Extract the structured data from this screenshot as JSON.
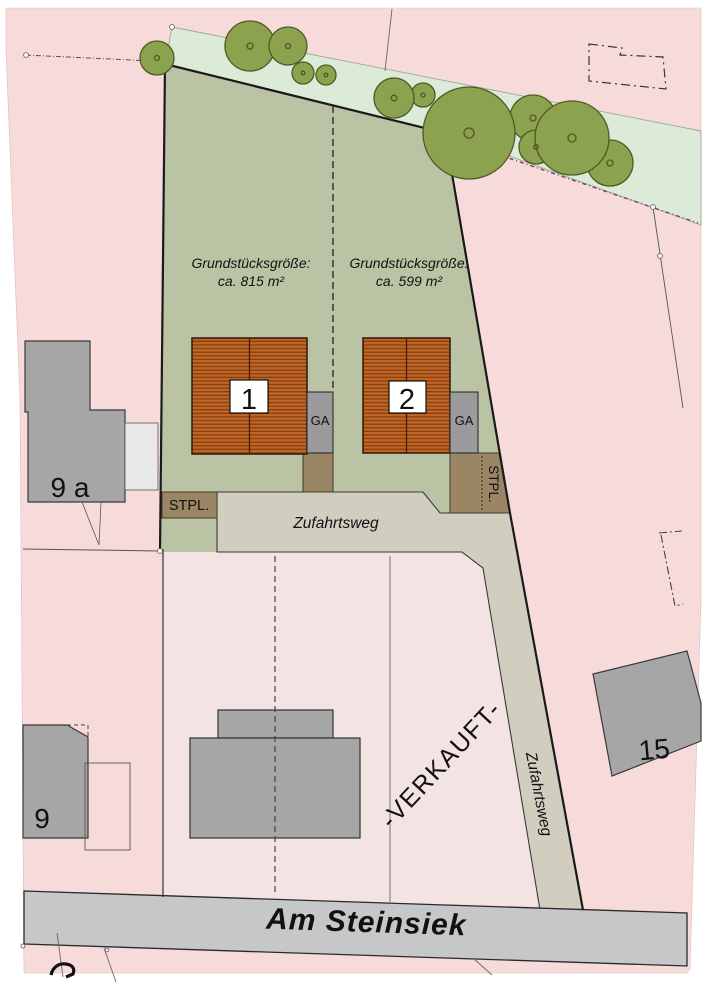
{
  "canvas": {
    "width": 707,
    "height": 1000
  },
  "plots": [
    {
      "size_label": "Grundstücksgröße:",
      "size_value": "ca. 815 m²",
      "house_number": "1",
      "garage_label": "GA"
    },
    {
      "size_label": "Grundstücksgröße:",
      "size_value": "ca. 599 m²",
      "house_number": "2",
      "garage_label": "GA"
    }
  ],
  "parking": {
    "left_label": "STPL.",
    "right_label": "STPL."
  },
  "roads": {
    "access_road_label": "Zufahrtsweg",
    "access_road_label_vertical": "Zufahrtsweg",
    "street_name": "Am Steinsiek"
  },
  "status": {
    "sold_stamp": "-VERKAUFT-"
  },
  "neighbors": {
    "house_9a": "9 a",
    "house_9": "9",
    "house_15": "15"
  },
  "colors": {
    "background": "#ffffff",
    "parcel_pink": "#f7dbdb",
    "sold_parcel_pink": "#f3e3e3",
    "green_strip": "#dcead8",
    "plot_green": "#bac4a4",
    "plot_green_dot": "#a8b28f",
    "roof_orange": "#bf6627",
    "roof_stripe": "#87400f",
    "garage_gray": "#9b9b9d",
    "parking_brown": "#9a8565",
    "driveway_beige": "#d1cec0",
    "street_gray": "#c5c7c9",
    "building_gray": "#a6a6a6",
    "tree_green": "#8da24e",
    "sold_text_red": "#d43333",
    "boundary_black": "#1a1a1a"
  }
}
